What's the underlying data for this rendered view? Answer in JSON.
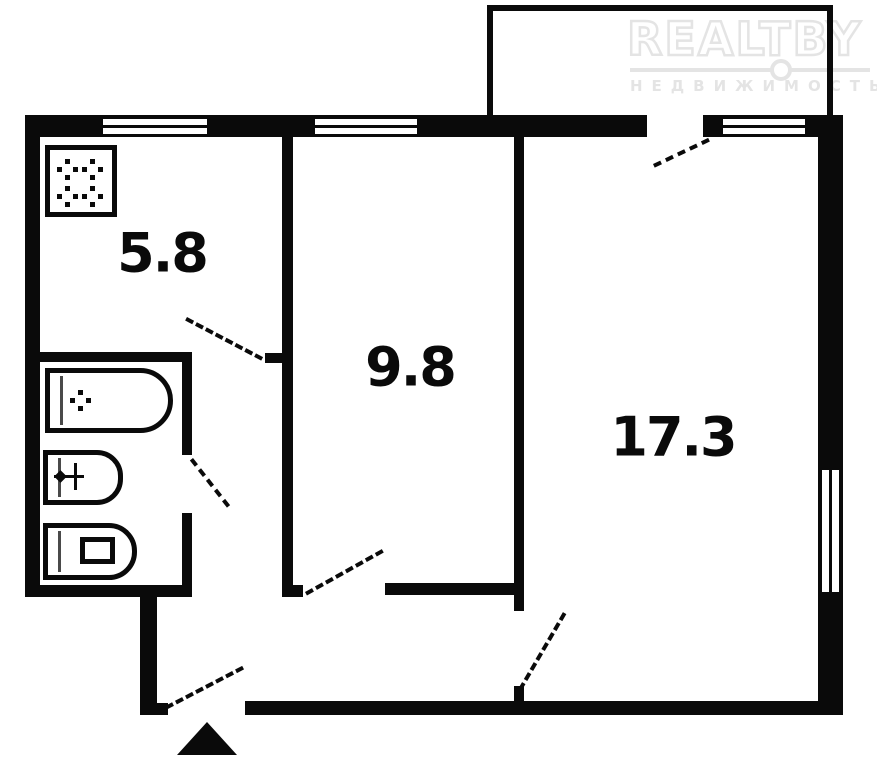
{
  "brand": {
    "name_left": "REALT",
    "name_right": "BY",
    "subtitle": "НЕДВИЖИМОСТЬ"
  },
  "rooms": {
    "kitchen": {
      "label": "5.8"
    },
    "bedroom": {
      "label": "9.8"
    },
    "living_room": {
      "label": "17.3"
    }
  },
  "icons": {
    "stove": "stove-icon",
    "bathtub": "bathtub-icon",
    "sink": "sink-icon",
    "toilet": "toilet-icon",
    "entrance": "entrance-arrow-icon"
  },
  "colors": {
    "wall": "#0a0a0a",
    "background": "#ffffff",
    "watermark": "#e4e4e4"
  }
}
